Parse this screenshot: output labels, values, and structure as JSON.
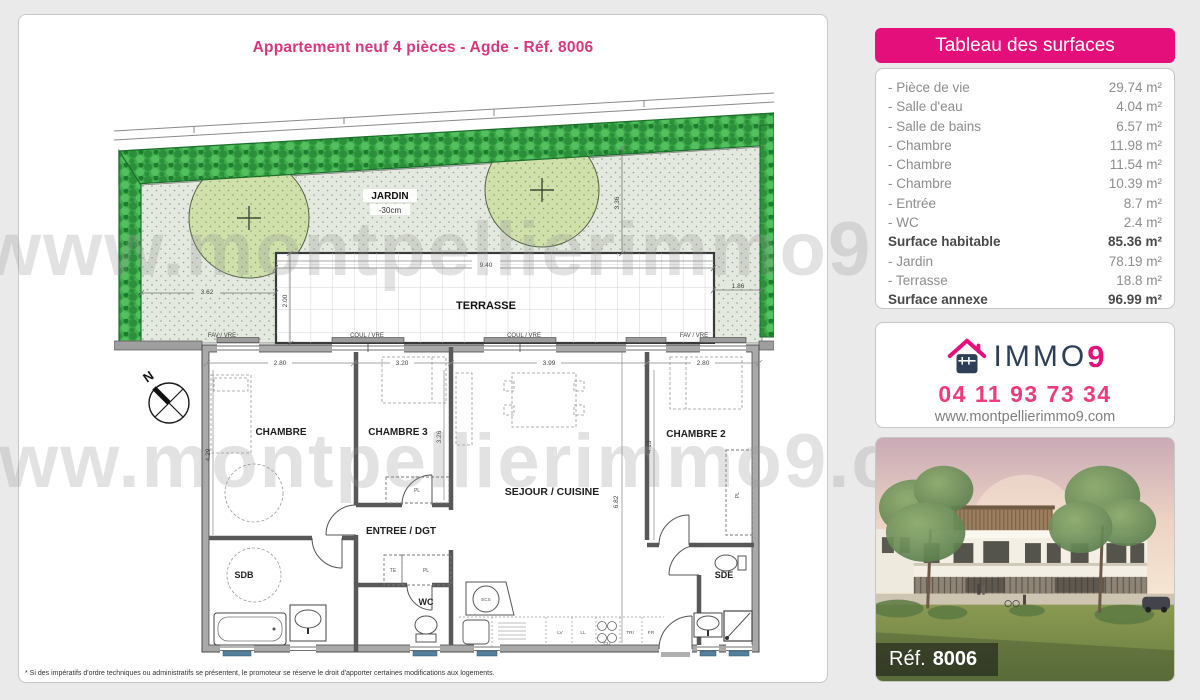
{
  "page": {
    "title": "Appartement neuf 4 pièces - Agde - Réf. 8006",
    "disclaimer": "* Si des impératifs d'ordre techniques ou administratifs se présentent, le promoteur se réserve le droit d'apporter certaines modifications aux logements."
  },
  "watermark": {
    "row1": "www.montpellierimmo9.com",
    "row2": "www.montpellierimmo9.com"
  },
  "surfaces": {
    "header": "Tableau des surfaces",
    "rows": [
      {
        "label": "- Pièce de vie",
        "value": "29.74 m²",
        "bold": false
      },
      {
        "label": "- Salle d'eau",
        "value": "4.04 m²",
        "bold": false
      },
      {
        "label": "- Salle de bains",
        "value": "6.57 m²",
        "bold": false
      },
      {
        "label": "- Chambre",
        "value": "11.98 m²",
        "bold": false
      },
      {
        "label": "- Chambre",
        "value": "11.54 m²",
        "bold": false
      },
      {
        "label": "- Chambre",
        "value": "10.39 m²",
        "bold": false
      },
      {
        "label": "- Entrée",
        "value": "8.7 m²",
        "bold": false
      },
      {
        "label": "- WC",
        "value": "2.4 m²",
        "bold": false
      },
      {
        "label": "Surface habitable",
        "value": "85.36 m²",
        "bold": true
      },
      {
        "label": "- Jardin",
        "value": "78.19 m²",
        "bold": false
      },
      {
        "label": "- Terrasse",
        "value": "18.8 m²",
        "bold": false
      },
      {
        "label": "Surface annexe",
        "value": "96.99 m²",
        "bold": true
      }
    ]
  },
  "contact": {
    "brand_immo": "IMMO",
    "brand_9": "9",
    "phone": "04 11 93 73 34",
    "website": "www.montpellierimmo9.com"
  },
  "photo": {
    "ref_label": "Réf.",
    "ref_number": "8006"
  },
  "plan": {
    "compass": "N",
    "rooms": {
      "jardin": "JARDIN",
      "jardin_depth": "-30cm",
      "terrasse": "TERRASSE",
      "chambre": "CHAMBRE",
      "chambre3": "CHAMBRE 3",
      "chambre2": "CHAMBRE 2",
      "entree": "ENTREE / DGT",
      "sejour": "SEJOUR / CUISINE",
      "sdb": "SDB",
      "wc": "WC",
      "sde": "SDE"
    },
    "small_labels": {
      "fav_vre": "FAV / VRE",
      "coul_vre": "COUL / VRE",
      "pl": "PL",
      "te": "TE",
      "ecs": "ECS",
      "lv": "LV",
      "ll": "LL",
      "cu": "CU",
      "tri": "TRI",
      "fr": "FR"
    },
    "dims": {
      "d362": "3.62",
      "d200": "2.00",
      "d940": "9.40",
      "d336": "3.36",
      "d186": "1.86",
      "d280a": "2.80",
      "d320": "3.20",
      "d399": "3.99",
      "d280b": "2.80",
      "d429": "4.29",
      "d326": "3.26",
      "d682": "6.82",
      "d413": "4.13"
    }
  },
  "colors": {
    "pink_primary": "#e50f7c",
    "pink_title": "#d6377f",
    "pink_phone": "#ee3b7e",
    "navy_brand": "#2e4057",
    "hedge_green": "#3eac4b",
    "garden_fill": "#e3e9de",
    "tree_fill": "#cfe0ab",
    "fixture_blue": "#54809e",
    "page_background": "#eaeaea"
  }
}
